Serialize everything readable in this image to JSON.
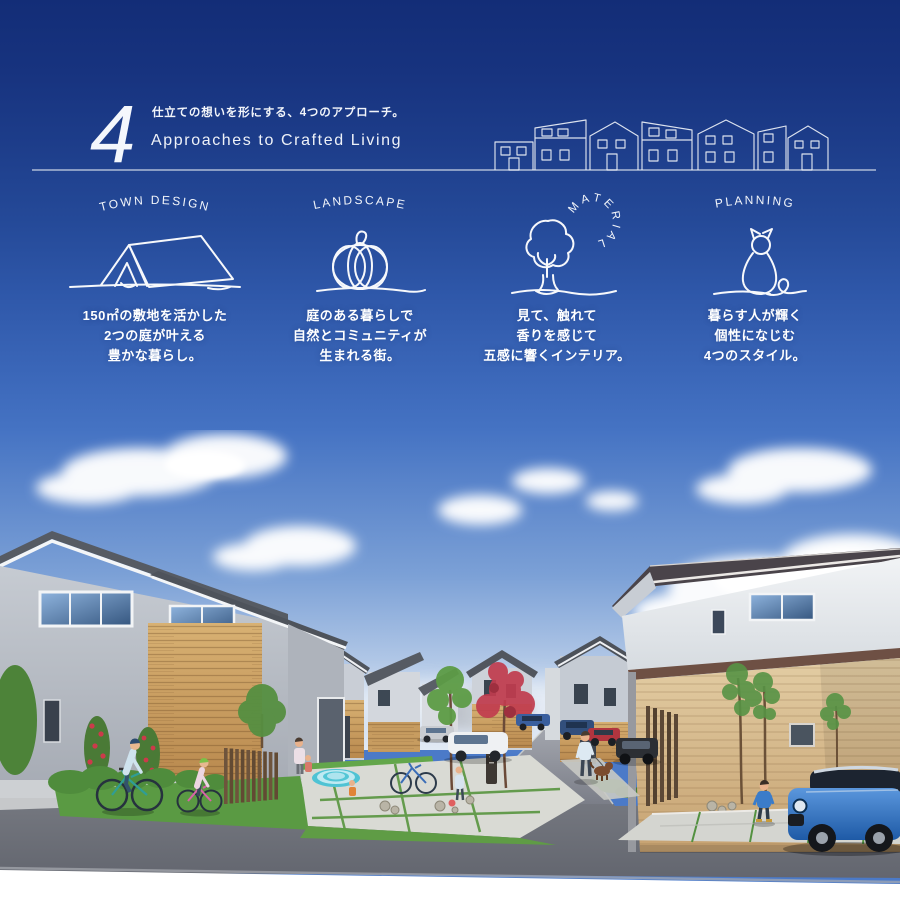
{
  "header": {
    "number": "4",
    "tagline_jp": "仕立ての想いを形にする、4つのアプローチ。",
    "title_en": "Approaches to Crafted Living"
  },
  "approaches": [
    {
      "label": "TOWN DESIGN",
      "icon": "tent-icon",
      "lines": [
        "150㎡の敷地を活かした",
        "2つの庭が叶える",
        "豊かな暮らし。"
      ]
    },
    {
      "label": "LANDSCAPE",
      "icon": "pumpkin-icon",
      "lines": [
        "庭のある暮らしで",
        "自然とコミュニティが",
        "生まれる街。"
      ]
    },
    {
      "label": "MATERIAL",
      "icon": "tree-icon",
      "lines": [
        "見て、触れて",
        "香りを感じて",
        "五感に響くインテリア。"
      ]
    },
    {
      "label": "PLANNING",
      "icon": "cat-icon",
      "lines": [
        "暮らす人が輝く",
        "個性になじむ",
        "4つのスタイル。"
      ]
    }
  ],
  "icons": {
    "header_illustration": "houses-row-illustration",
    "town_design": "tent-icon",
    "landscape": "pumpkin-icon",
    "material": "tree-icon",
    "planning": "cat-icon"
  },
  "palette": {
    "sky_top": "#132D77",
    "sky_mid": "#3A66B8",
    "sky_photo": "#4573C3",
    "horizon_haze": "#E2EAF5",
    "cloud": "#FFFFFF",
    "text": "#FFFFFF",
    "wood_wall": "#C89B5E",
    "pale_wood_wall": "#D9BF94",
    "roof_dark": "#4E525B",
    "wall_gray": "#B9BEC6",
    "wall_white": "#ECEEF1",
    "road_asphalt": "#6E717C",
    "grass": "#5C9B44",
    "red_foliage": "#C13C4E",
    "pool_teal": "#52C5D6",
    "mini_car_blue": "#2F72C4",
    "bottom_fade": "#FFFFFF"
  }
}
